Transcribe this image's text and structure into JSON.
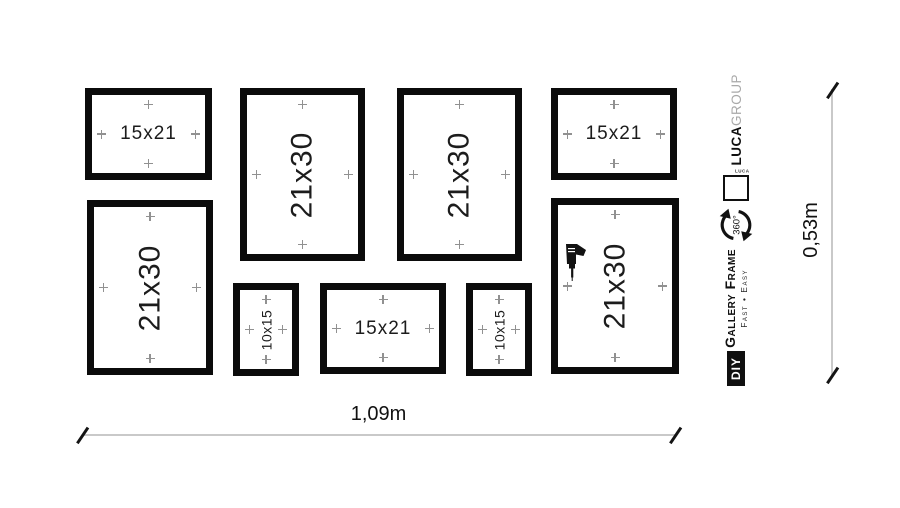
{
  "frames": [
    {
      "label": "15x21",
      "orientation": "landscape"
    },
    {
      "label": "21x30",
      "orientation": "portrait"
    },
    {
      "label": "21x30",
      "orientation": "portrait"
    },
    {
      "label": "15x21",
      "orientation": "landscape"
    },
    {
      "label": "21x30",
      "orientation": "portrait"
    },
    {
      "label": "10x15",
      "orientation": "portrait"
    },
    {
      "label": "15x21",
      "orientation": "landscape"
    },
    {
      "label": "10x15",
      "orientation": "portrait"
    },
    {
      "label": "21x30",
      "orientation": "portrait",
      "icon": "drill"
    }
  ],
  "dimensions": {
    "width": "1,09m",
    "height": "0,53m"
  },
  "branding": {
    "diy": "DIY",
    "product": "Gallery Frame",
    "tagline": "Fast • Easy",
    "rotation": "360°",
    "logo_text": "LUCA",
    "brand_bold": "LUCA",
    "brand_light": "GROUP"
  },
  "colors": {
    "frame_border": "#0b0b0b",
    "marker": "#919191",
    "dimension_line": "#c9c9c9",
    "text": "#161616",
    "brand_light_gray": "#a9a9a9"
  }
}
